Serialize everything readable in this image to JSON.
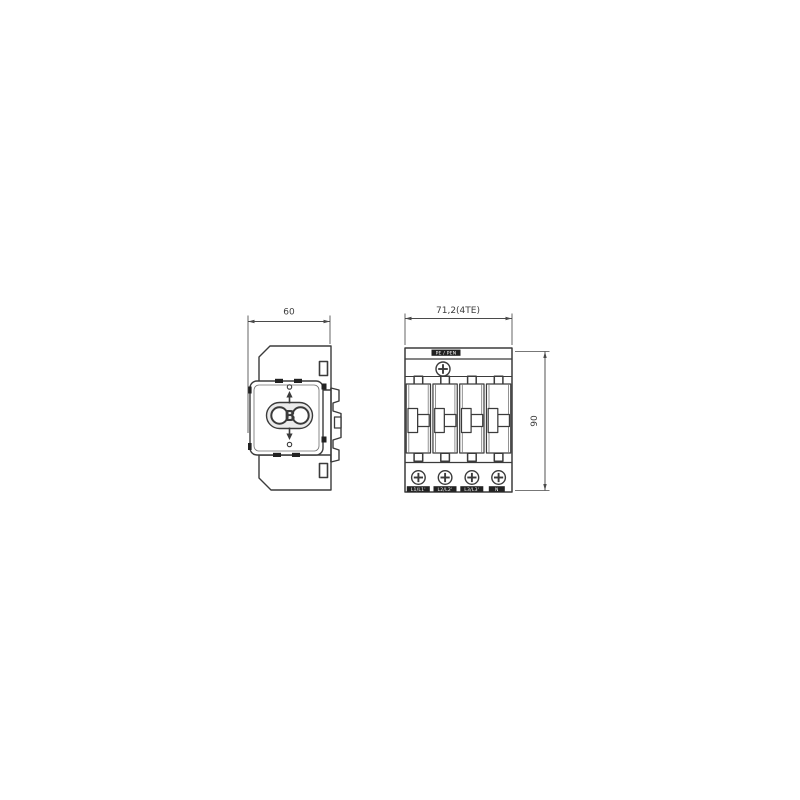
{
  "canvas": {
    "background": "#ffffff"
  },
  "drawing": {
    "line_color": "#3b3b3b",
    "dimension_color": "#4a4a4a",
    "side_view": {
      "logo": "OBO",
      "logo_letter": "B",
      "width_dim": "60"
    },
    "front_view": {
      "module_count": 4,
      "width_dim": "71,2(4TE)",
      "height_dim": "90",
      "top_terminal_label": "PE / PEN",
      "terminal_labels": [
        "L1/L1'",
        "L2/L2'",
        "L3/L3'",
        "N"
      ]
    }
  }
}
